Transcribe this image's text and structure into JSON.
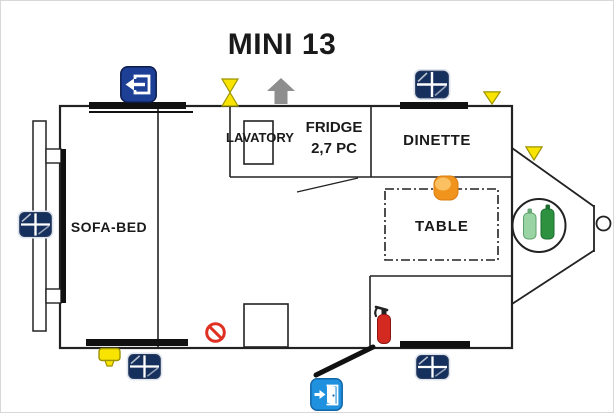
{
  "title": "MINI 13",
  "rooms": {
    "sofa_bed": "SOFA-BED",
    "lavatory": "LAVATORY",
    "fridge_line1": "FRIDGE",
    "fridge_line2": "2,7 PC",
    "dinette": "DINETTE",
    "table": "TABLE"
  },
  "colors": {
    "wall": "#222222",
    "window_bar": "#111111",
    "window_icon_navy": "#16305e",
    "window_icon_frame": "#dfe5ee",
    "exit_icon_blue": "#1e3f96",
    "entry_icon_blue": "#2091de",
    "marker_yellow": "#f8e400",
    "marker_yellow_border": "#9c9400",
    "arrow_gray": "#8e8e8e",
    "heater_orange": "#f0941e",
    "heater_orange_light": "#fcc468",
    "extinguisher_red": "#d42920",
    "prohibition_red": "#e03022",
    "bottle_light_green": "#9ad4a4",
    "bottle_dark_green": "#2e9140",
    "text": "#1a1a1a"
  },
  "icons": [
    "window-icon",
    "exit-door-icon",
    "entry-door-icon",
    "roof-vent-valve-icon",
    "direction-arrow-icon",
    "warning-triangle-icon",
    "gas-bottles-icon",
    "fire-extinguisher-icon",
    "no-smoking-icon",
    "corner-jack-icon",
    "heater-icon"
  ]
}
